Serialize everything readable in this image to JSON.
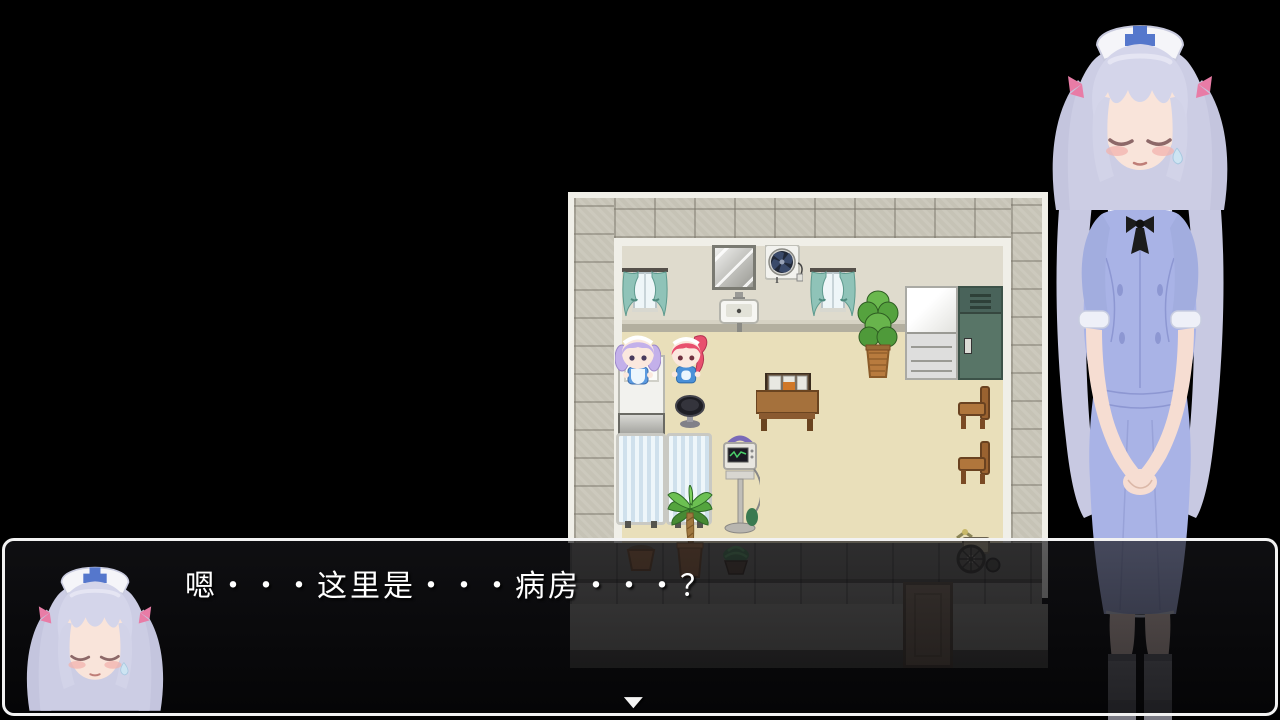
{
  "scene": {
    "type": "rpg-game-screen",
    "background_color": "#000000"
  },
  "dialogue": {
    "text": "嗯・・・这里是・・・病房・・・？",
    "speaker_portrait": "nurse",
    "continue_indicator": "▼",
    "text_color": "#ffffff",
    "box_border_color": "#f2f2f2"
  },
  "map": {
    "name": "hospital-ward-room",
    "colors": {
      "floor": "#e9dfba",
      "wall": "#dcd8ca",
      "stone_border": "#c6c3b6",
      "trim": "#f0efe8",
      "curtain": "#8fc3b8",
      "locker": "#587567"
    },
    "objects": [
      "curtained-window",
      "wall-mirror",
      "ventilation-fan",
      "curtained-window",
      "wall-sink",
      "potted-plant",
      "refrigerator",
      "storage-locker",
      "hospital-bed",
      "purple-haired-maid",
      "pink-haired-maid",
      "stool",
      "desk-with-trays",
      "privacy-screen",
      "privacy-screen",
      "palm-plant",
      "medical-monitor-stand",
      "wooden-chair",
      "wooden-chair",
      "flower-pot",
      "potted-seedling",
      "wheelchair",
      "door"
    ]
  },
  "characters": {
    "nurse_art": {
      "name": "nurse",
      "hair_color": "#cccde4",
      "dress_color": "#a9b3e6",
      "cap_cross_color": "#5577cc",
      "ribbon_color": "#e87ca6",
      "stockings_color": "#8f8f98",
      "skin_color": "#f9e4da"
    },
    "map_sprites": [
      {
        "name": "purple-haired-maid",
        "hair_color": "#c3b0ea",
        "dress_color": "#5a9ae0"
      },
      {
        "name": "pink-haired-maid",
        "hair_color": "#e8506e",
        "dress_color": "#4a90d8"
      }
    ]
  }
}
